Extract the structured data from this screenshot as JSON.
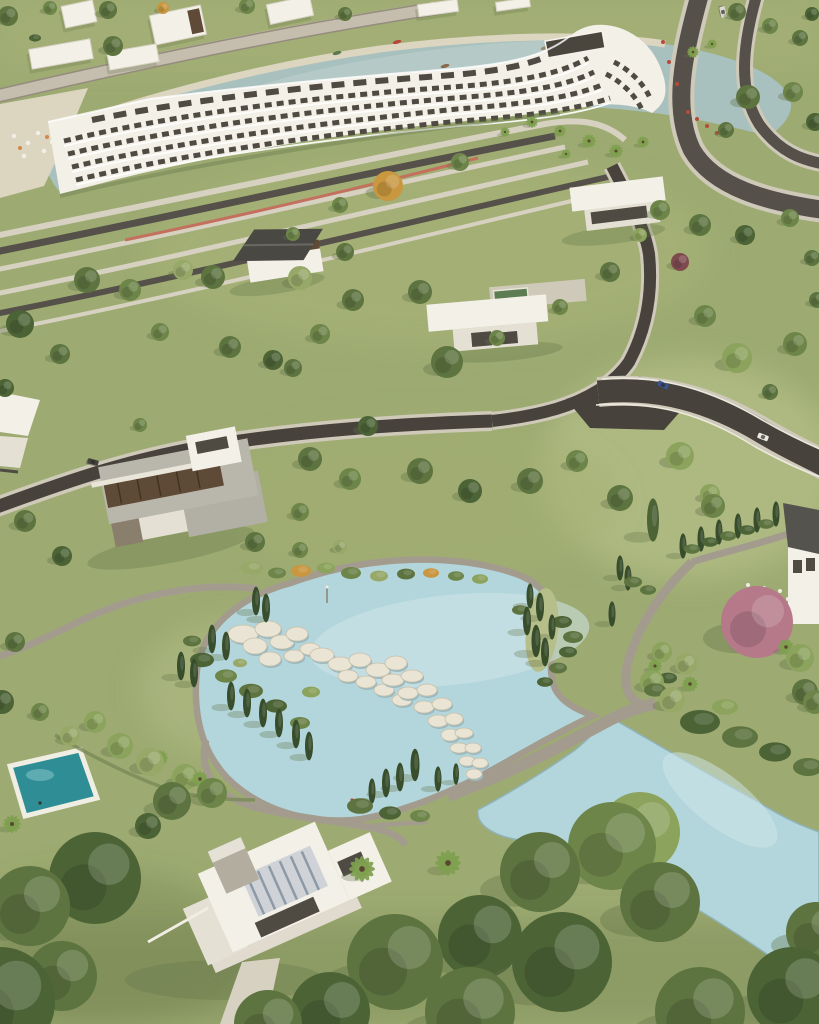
{
  "scene": {
    "label": "aerial-view-lakeside-resort-park"
  },
  "palette": {
    "grass": "#9dab72",
    "grass_light": "#b6bf8a",
    "sand": "#dcd5c0",
    "lagoon": "#a9c1be",
    "pond": "#b3d6dc",
    "pond_light": "#cfe6ea",
    "pool": "#2e8d95",
    "shore": "#8fb3ba",
    "road": "#55504a",
    "road_dark": "#47423c",
    "path": "#a39c8e",
    "path_light": "#cfc9b9",
    "sidewalk": "#d7d1c1",
    "bike": "#c4705e",
    "white_wall": "#f3f0e8",
    "white_dim": "#e4e0d3",
    "win": "#4f4a42",
    "roof_gray": "#b9b6ac",
    "roof_dark": "#4a4843",
    "wood": "#5f4a38",
    "concrete": "#b3ada0",
    "skylight": "#cfd3d8",
    "skylight_rib": "#8e99a6",
    "stone": "#e9e4d4",
    "stone_edge": "#c6bfa9",
    "stone_under": "#9bb9bf",
    "shadow": "#5f6f45",
    "track": "#c5beae",
    "track_line": "#948c7c",
    "pool_green": "#5c7d52"
  },
  "tree_colors": [
    "#6d8549",
    "#5d7440",
    "#8ba35c",
    "#4c6336",
    "#97a868",
    "#c9973f",
    "#b5798a",
    "#374d2b",
    "#7fa04f",
    "#7e4a50"
  ],
  "trees": [
    [
      8,
      16,
      10,
      "r",
      1
    ],
    [
      50,
      8,
      7,
      "r",
      0
    ],
    [
      108,
      10,
      9,
      "r",
      1
    ],
    [
      163,
      8,
      6,
      "r",
      5
    ],
    [
      247,
      6,
      8,
      "r",
      0
    ],
    [
      345,
      14,
      7,
      "r",
      1
    ],
    [
      113,
      46,
      10,
      "r",
      1
    ],
    [
      35,
      38,
      6,
      "b",
      3
    ],
    [
      737,
      12,
      9,
      "r",
      1
    ],
    [
      770,
      26,
      8,
      "r",
      0
    ],
    [
      800,
      38,
      8,
      "r",
      1
    ],
    [
      812,
      14,
      7,
      "r",
      3
    ],
    [
      693,
      52,
      6,
      "p",
      8
    ],
    [
      712,
      44,
      5,
      "p",
      8
    ],
    [
      748,
      97,
      12,
      "r",
      1
    ],
    [
      793,
      92,
      10,
      "r",
      0
    ],
    [
      815,
      122,
      9,
      "r",
      3
    ],
    [
      726,
      130,
      8,
      "r",
      1
    ],
    [
      532,
      122,
      6,
      "p",
      8
    ],
    [
      560,
      131,
      6,
      "p",
      8
    ],
    [
      589,
      141,
      7,
      "p",
      8
    ],
    [
      616,
      151,
      7,
      "p",
      8
    ],
    [
      643,
      142,
      6,
      "p",
      8
    ],
    [
      566,
      154,
      5,
      "p",
      8
    ],
    [
      505,
      132,
      5,
      "p",
      8
    ],
    [
      460,
      162,
      9,
      "r",
      0
    ],
    [
      388,
      186,
      15,
      "r",
      5
    ],
    [
      340,
      205,
      8,
      "r",
      0
    ],
    [
      300,
      278,
      12,
      "r",
      4
    ],
    [
      183,
      270,
      10,
      "r",
      4
    ],
    [
      87,
      280,
      13,
      "r",
      1
    ],
    [
      20,
      324,
      14,
      "r",
      3
    ],
    [
      130,
      290,
      11,
      "r",
      0
    ],
    [
      213,
      277,
      12,
      "r",
      1
    ],
    [
      345,
      252,
      9,
      "r",
      1
    ],
    [
      293,
      234,
      7,
      "r",
      0
    ],
    [
      660,
      210,
      10,
      "r",
      0
    ],
    [
      700,
      225,
      11,
      "r",
      1
    ],
    [
      745,
      235,
      10,
      "r",
      3
    ],
    [
      790,
      218,
      9,
      "r",
      0
    ],
    [
      680,
      262,
      9,
      "r",
      9
    ],
    [
      812,
      258,
      8,
      "r",
      1
    ],
    [
      640,
      235,
      7,
      "r",
      2
    ],
    [
      353,
      300,
      11,
      "r",
      1
    ],
    [
      320,
      334,
      10,
      "r",
      0
    ],
    [
      230,
      347,
      11,
      "r",
      1
    ],
    [
      273,
      360,
      10,
      "r",
      3
    ],
    [
      293,
      368,
      9,
      "r",
      1
    ],
    [
      160,
      332,
      9,
      "r",
      0
    ],
    [
      60,
      354,
      10,
      "r",
      1
    ],
    [
      5,
      388,
      9,
      "r",
      3
    ],
    [
      420,
      292,
      12,
      "r",
      1
    ],
    [
      447,
      362,
      16,
      "r",
      1
    ],
    [
      497,
      338,
      8,
      "r",
      0
    ],
    [
      610,
      272,
      10,
      "r",
      1
    ],
    [
      560,
      307,
      8,
      "r",
      0
    ],
    [
      705,
      316,
      11,
      "r",
      0
    ],
    [
      737,
      358,
      15,
      "r",
      2
    ],
    [
      795,
      344,
      12,
      "r",
      0
    ],
    [
      770,
      392,
      8,
      "r",
      1
    ],
    [
      817,
      300,
      8,
      "r",
      1
    ],
    [
      368,
      426,
      10,
      "r",
      3
    ],
    [
      310,
      459,
      12,
      "r",
      1
    ],
    [
      350,
      479,
      11,
      "r",
      0
    ],
    [
      420,
      471,
      13,
      "r",
      1
    ],
    [
      470,
      491,
      12,
      "r",
      3
    ],
    [
      530,
      481,
      13,
      "r",
      1
    ],
    [
      577,
      461,
      11,
      "r",
      0
    ],
    [
      620,
      498,
      13,
      "r",
      1
    ],
    [
      680,
      456,
      14,
      "r",
      2
    ],
    [
      713,
      506,
      12,
      "r",
      0
    ],
    [
      25,
      521,
      11,
      "r",
      1
    ],
    [
      62,
      556,
      10,
      "r",
      3
    ],
    [
      255,
      542,
      10,
      "r",
      1
    ],
    [
      300,
      512,
      9,
      "r",
      0
    ],
    [
      140,
      425,
      7,
      "r",
      0
    ],
    [
      256,
      601,
      4,
      "c",
      7
    ],
    [
      266,
      608,
      4,
      "c",
      7
    ],
    [
      212,
      639,
      4,
      "c",
      7
    ],
    [
      226,
      646,
      4,
      "c",
      7
    ],
    [
      181,
      666,
      4,
      "c",
      7
    ],
    [
      194,
      673,
      4,
      "c",
      7
    ],
    [
      231,
      696,
      4,
      "c",
      7
    ],
    [
      247,
      703,
      4,
      "c",
      7
    ],
    [
      263,
      713,
      4,
      "c",
      7
    ],
    [
      279,
      723,
      4,
      "c",
      7
    ],
    [
      296,
      734,
      4,
      "c",
      7
    ],
    [
      309,
      746,
      4,
      "c",
      7
    ],
    [
      202,
      660,
      12,
      "b",
      3
    ],
    [
      226,
      676,
      11,
      "b",
      0
    ],
    [
      251,
      691,
      12,
      "b",
      1
    ],
    [
      276,
      706,
      11,
      "b",
      3
    ],
    [
      300,
      723,
      10,
      "b",
      0
    ],
    [
      192,
      641,
      9,
      "b",
      1
    ],
    [
      311,
      692,
      9,
      "b",
      2
    ],
    [
      240,
      663,
      7,
      "b",
      4
    ],
    [
      252,
      568,
      11,
      "b",
      4
    ],
    [
      277,
      573,
      9,
      "b",
      0
    ],
    [
      301,
      571,
      10,
      "b",
      5
    ],
    [
      326,
      568,
      9,
      "b",
      2
    ],
    [
      351,
      573,
      10,
      "b",
      0
    ],
    [
      379,
      576,
      9,
      "b",
      4
    ],
    [
      406,
      574,
      9,
      "b",
      1
    ],
    [
      431,
      573,
      8,
      "b",
      5
    ],
    [
      456,
      576,
      8,
      "b",
      0
    ],
    [
      480,
      579,
      8,
      "b",
      2
    ],
    [
      300,
      550,
      8,
      "r",
      0
    ],
    [
      340,
      547,
      7,
      "r",
      4
    ],
    [
      530,
      596,
      3.5,
      "c",
      7
    ],
    [
      540,
      607,
      4,
      "c",
      7
    ],
    [
      527,
      621,
      4,
      "c",
      7
    ],
    [
      536,
      641,
      4.5,
      "c",
      7
    ],
    [
      545,
      652,
      4,
      "c",
      7
    ],
    [
      552,
      627,
      3.5,
      "c",
      7
    ],
    [
      562,
      622,
      10,
      "b",
      3
    ],
    [
      573,
      637,
      10,
      "b",
      1
    ],
    [
      568,
      652,
      9,
      "b",
      3
    ],
    [
      558,
      668,
      9,
      "b",
      1
    ],
    [
      545,
      682,
      8,
      "b",
      3
    ],
    [
      520,
      610,
      8,
      "b",
      1
    ],
    [
      620,
      568,
      3.5,
      "c",
      7
    ],
    [
      628,
      578,
      3.5,
      "c",
      7
    ],
    [
      648,
      590,
      8,
      "b",
      1
    ],
    [
      612,
      614,
      3.5,
      "c",
      7
    ],
    [
      652,
      682,
      12,
      "r",
      2
    ],
    [
      672,
      700,
      13,
      "r",
      4
    ],
    [
      662,
      652,
      10,
      "r",
      2
    ],
    [
      686,
      664,
      11,
      "r",
      4
    ],
    [
      690,
      684,
      8,
      "p",
      8
    ],
    [
      655,
      666,
      7,
      "p",
      8
    ],
    [
      372,
      791,
      3.5,
      "c",
      7
    ],
    [
      386,
      783,
      4,
      "c",
      7
    ],
    [
      400,
      777,
      4,
      "c",
      7
    ],
    [
      415,
      765,
      4.5,
      "c",
      7
    ],
    [
      438,
      779,
      3.5,
      "c",
      7
    ],
    [
      456,
      774,
      3,
      "c",
      7
    ],
    [
      360,
      806,
      13,
      "b",
      1
    ],
    [
      390,
      813,
      11,
      "b",
      3
    ],
    [
      420,
      816,
      10,
      "b",
      0
    ],
    [
      655,
      690,
      11,
      "b",
      1
    ],
    [
      668,
      678,
      9,
      "b",
      3
    ],
    [
      653,
      520,
      6,
      "c",
      3
    ],
    [
      710,
      494,
      10,
      "r",
      2
    ],
    [
      683,
      546,
      3.5,
      "c",
      7
    ],
    [
      701,
      539,
      3.5,
      "c",
      7
    ],
    [
      719,
      532,
      3.5,
      "c",
      7
    ],
    [
      738,
      526,
      3.5,
      "c",
      7
    ],
    [
      757,
      520,
      3.5,
      "c",
      7
    ],
    [
      776,
      514,
      3.5,
      "c",
      7
    ],
    [
      692,
      549,
      8,
      "b",
      1
    ],
    [
      710,
      542,
      8,
      "b",
      3
    ],
    [
      728,
      536,
      8,
      "b",
      1
    ],
    [
      747,
      530,
      8,
      "b",
      3
    ],
    [
      766,
      524,
      8,
      "b",
      1
    ],
    [
      633,
      582,
      9,
      "b",
      1
    ],
    [
      757,
      622,
      36,
      "f",
      6
    ],
    [
      805,
      692,
      13,
      "r",
      1
    ],
    [
      800,
      658,
      14,
      "r",
      2
    ],
    [
      786,
      647,
      8,
      "p",
      8
    ],
    [
      120,
      746,
      13,
      "r",
      2
    ],
    [
      150,
      762,
      14,
      "r",
      4
    ],
    [
      185,
      777,
      13,
      "r",
      2
    ],
    [
      215,
      790,
      12,
      "r",
      4
    ],
    [
      160,
      758,
      8,
      "p",
      8
    ],
    [
      200,
      779,
      8,
      "p",
      8
    ],
    [
      95,
      722,
      11,
      "r",
      2
    ],
    [
      70,
      736,
      10,
      "r",
      4
    ],
    [
      40,
      712,
      9,
      "r",
      0
    ],
    [
      15,
      642,
      10,
      "r",
      1
    ],
    [
      2,
      702,
      12,
      "r",
      3
    ],
    [
      95,
      878,
      46,
      "r",
      3
    ],
    [
      30,
      906,
      40,
      "r",
      1
    ],
    [
      0,
      1002,
      55,
      "r",
      3
    ],
    [
      62,
      976,
      35,
      "r",
      1
    ],
    [
      172,
      801,
      19,
      "r",
      1
    ],
    [
      212,
      793,
      15,
      "r",
      0
    ],
    [
      148,
      826,
      13,
      "r",
      3
    ],
    [
      12,
      824,
      9,
      "p",
      8
    ],
    [
      362,
      869,
      13,
      "p",
      8
    ],
    [
      448,
      863,
      13,
      "p",
      8
    ],
    [
      395,
      962,
      48,
      "r",
      1
    ],
    [
      480,
      937,
      42,
      "r",
      3
    ],
    [
      540,
      872,
      40,
      "r",
      1
    ],
    [
      612,
      846,
      44,
      "r",
      0
    ],
    [
      562,
      962,
      50,
      "r",
      3
    ],
    [
      470,
      1012,
      45,
      "r",
      1
    ],
    [
      660,
      902,
      40,
      "r",
      1
    ],
    [
      640,
      832,
      40,
      "r",
      2
    ],
    [
      330,
      1012,
      40,
      "r",
      3
    ],
    [
      268,
      1024,
      34,
      "r",
      1
    ],
    [
      700,
      1012,
      45,
      "r",
      1
    ],
    [
      792,
      992,
      45,
      "r",
      3
    ],
    [
      816,
      932,
      30,
      "r",
      1
    ],
    [
      700,
      722,
      20,
      "b",
      3
    ],
    [
      740,
      737,
      18,
      "b",
      1
    ],
    [
      775,
      752,
      16,
      "b",
      3
    ],
    [
      808,
      767,
      15,
      "b",
      1
    ],
    [
      725,
      707,
      13,
      "b",
      2
    ],
    [
      815,
      702,
      12,
      "r",
      0
    ]
  ],
  "stones": [
    [
      243,
      634,
      15,
      9
    ],
    [
      268,
      629,
      13,
      8
    ],
    [
      255,
      646,
      12,
      8
    ],
    [
      282,
      642,
      12,
      7
    ],
    [
      297,
      634,
      11,
      7
    ],
    [
      270,
      659,
      11,
      7
    ],
    [
      294,
      656,
      10,
      6
    ],
    [
      310,
      649,
      10,
      6
    ],
    [
      322,
      655,
      12,
      7
    ],
    [
      340,
      664,
      12,
      7
    ],
    [
      360,
      660,
      11,
      7
    ],
    [
      378,
      670,
      12,
      7
    ],
    [
      396,
      663,
      11,
      7
    ],
    [
      348,
      676,
      10,
      6
    ],
    [
      366,
      682,
      10,
      6
    ],
    [
      384,
      690,
      10,
      6
    ],
    [
      402,
      700,
      10,
      6
    ],
    [
      393,
      680,
      11,
      6
    ],
    [
      412,
      676,
      11,
      6
    ],
    [
      408,
      693,
      10,
      6
    ],
    [
      427,
      690,
      10,
      6
    ],
    [
      424,
      707,
      10,
      6
    ],
    [
      442,
      704,
      10,
      6
    ],
    [
      438,
      721,
      10,
      6
    ],
    [
      454,
      719,
      9,
      6
    ],
    [
      450,
      735,
      9,
      6
    ],
    [
      464,
      733,
      9,
      5
    ],
    [
      459,
      748,
      9,
      5
    ],
    [
      473,
      748,
      8,
      5
    ],
    [
      467,
      761,
      8,
      5
    ],
    [
      480,
      763,
      8,
      5
    ],
    [
      474,
      774,
      8,
      5
    ]
  ],
  "boats": [
    [
      397,
      42,
      -15,
      "#b8473a"
    ],
    [
      337,
      53,
      -15,
      "#5a7a4a"
    ],
    [
      445,
      66,
      -15,
      "#8a6a4a"
    ],
    [
      545,
      48,
      -15,
      "#9a8a6a"
    ]
  ],
  "cars": [
    [
      663,
      385,
      25,
      "#3a5390"
    ],
    [
      763,
      437,
      22,
      "#eceae2"
    ],
    [
      93,
      462,
      15,
      "#45433f"
    ],
    [
      723,
      12,
      78,
      "#dcdad2"
    ]
  ],
  "umbrellas": [
    [
      14,
      136
    ],
    [
      28,
      143
    ],
    [
      44,
      151
    ],
    [
      24,
      156
    ],
    [
      52,
      142
    ],
    [
      38,
      133
    ]
  ],
  "umbrella_accents": [
    [
      20,
      148
    ],
    [
      47,
      137
    ]
  ],
  "flowers": [
    [
      688,
      112
    ],
    [
      697,
      119
    ],
    [
      707,
      126
    ],
    [
      717,
      133
    ],
    [
      663,
      42
    ],
    [
      669,
      62
    ],
    [
      677,
      84
    ]
  ],
  "people": [
    [
      352,
      800,
      "#b04a3a"
    ],
    [
      357,
      803,
      "#3c4c7c"
    ],
    [
      540,
      602,
      "#d8d4c8"
    ]
  ],
  "small_buildings": [
    [
      63,
      3,
      32,
      22,
      -12,
      0
    ],
    [
      152,
      10,
      52,
      30,
      -12,
      1
    ],
    [
      268,
      0,
      44,
      20,
      -12,
      0
    ],
    [
      30,
      44,
      62,
      20,
      -10,
      0
    ],
    [
      108,
      48,
      50,
      18,
      -10,
      0
    ],
    [
      418,
      2,
      40,
      12,
      -8,
      0
    ],
    [
      496,
      0,
      34,
      9,
      -8,
      0
    ]
  ]
}
